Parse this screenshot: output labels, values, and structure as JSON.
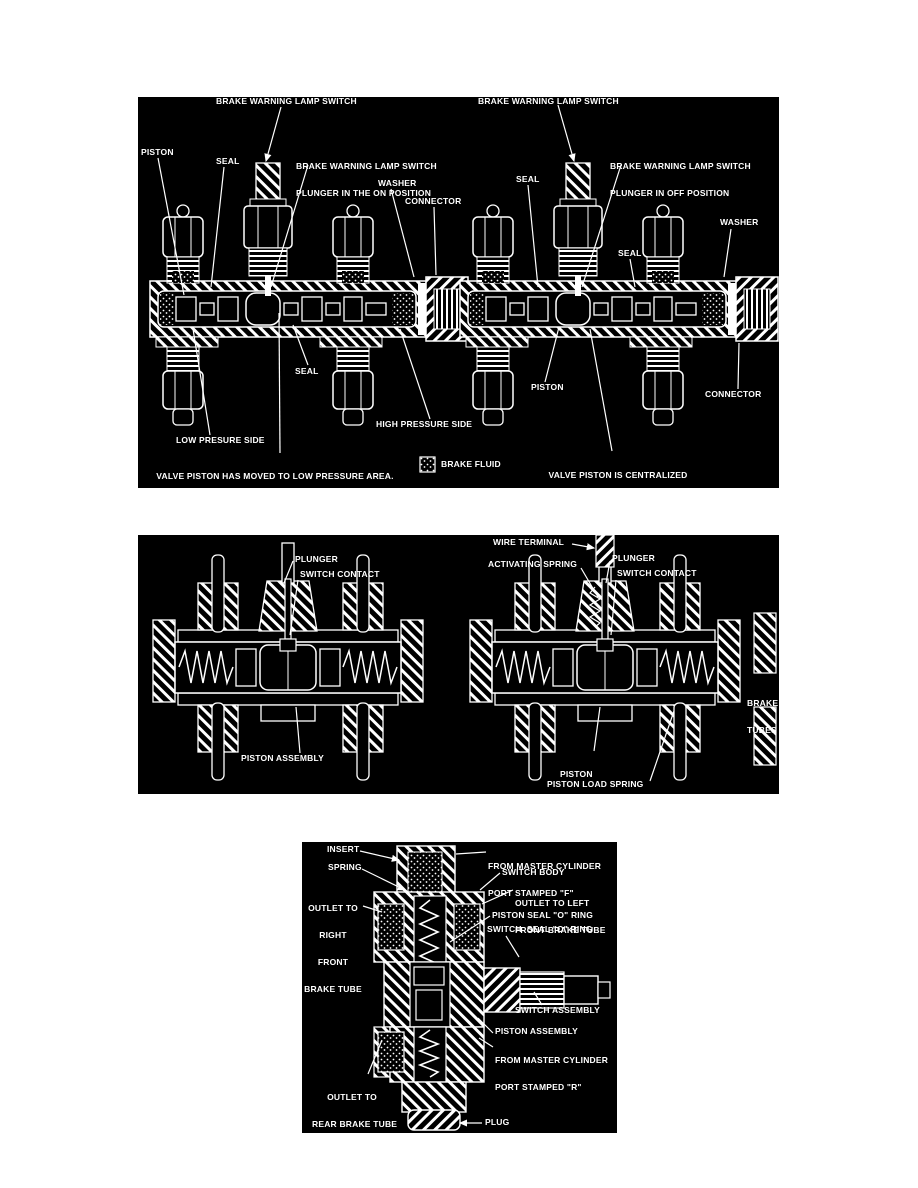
{
  "colors": {
    "page_bg": "#ffffff",
    "panel_bg": "#000000",
    "ink": "#ffffff"
  },
  "panel_top": {
    "left_diagram": {
      "switch": "BRAKE WARNING LAMP SWITCH",
      "piston": "PISTON",
      "seal_upper": "SEAL",
      "plunger_line1": "BRAKE WARNING LAMP SWITCH",
      "plunger_line2": "PLUNGER IN THE ON POSITION",
      "washer": "WASHER",
      "connector": "CONNECTOR",
      "seal_lower": "SEAL",
      "low_pressure": "LOW PRESURE SIDE",
      "high_pressure": "HIGH PRESSURE SIDE",
      "caption": [
        "VALVE PISTON HAS MOVED TO LOW PRESSURE AREA.",
        "WARNING LAMP SWITCH PLUNGER IS DEPRESSED.",
        "LIGHTING THE BRAKE WARNING LAMP."
      ]
    },
    "right_diagram": {
      "switch": "BRAKE WARNING LAMP SWITCH",
      "seal_upper": "SEAL",
      "plunger_line1": "BRAKE WARNING LAMP SWITCH",
      "plunger_line2": "PLUNGER IN OFF POSITION",
      "seal_mid": "SEAL",
      "washer": "WASHER",
      "piston": "PISTON",
      "connector": "CONNECTOR",
      "caption": [
        "VALVE PISTON IS CENTRALIZED",
        "PRIMARY AND SECONDARY SYSTEM",
        "PRESSURES ARE EQUALIZED"
      ]
    },
    "legend": "BRAKE FLUID"
  },
  "panel_middle": {
    "left_diagram": {
      "plunger": "PLUNGER",
      "switch_contact": "SWITCH CONTACT",
      "piston_assembly": "PISTON ASSEMBLY"
    },
    "right_diagram": {
      "wire_terminal": "WIRE TERMINAL",
      "activating_spring": "ACTIVATING SPRING",
      "plunger": "PLUNGER",
      "switch_contact": "SWITCH CONTACT",
      "brake_tubes": [
        "BRAKE",
        "TUBES"
      ],
      "piston_assembly": [
        "PISTON",
        "ASSEMBLY"
      ],
      "piston_load_spring": "PISTON LOAD SPRING"
    }
  },
  "panel_bottom": {
    "insert": "INSERT",
    "spring": "SPRING",
    "outlet_right_front": [
      "OUTLET TO",
      "RIGHT",
      "FRONT",
      "BRAKE TUBE"
    ],
    "from_master_f": [
      "FROM MASTER CYLINDER",
      "PORT STAMPED \"F\""
    ],
    "switch_body": "SWITCH BODY",
    "outlet_left_front": [
      "OUTLET TO LEFT",
      "FRONT BRAKE TUBE"
    ],
    "piston_seal": "PISTON SEAL \"O\" RING",
    "switch_seal": "SWITCH  SEAL \"O\" RING",
    "switch_assembly": "SWITCH ASSEMBLY",
    "piston_assembly": "PISTON ASSEMBLY",
    "from_master_r": [
      "FROM MASTER CYLINDER",
      "PORT STAMPED \"R\""
    ],
    "outlet_rear": [
      "OUTLET TO",
      "REAR BRAKE TUBE"
    ],
    "plug": "PLUG"
  }
}
